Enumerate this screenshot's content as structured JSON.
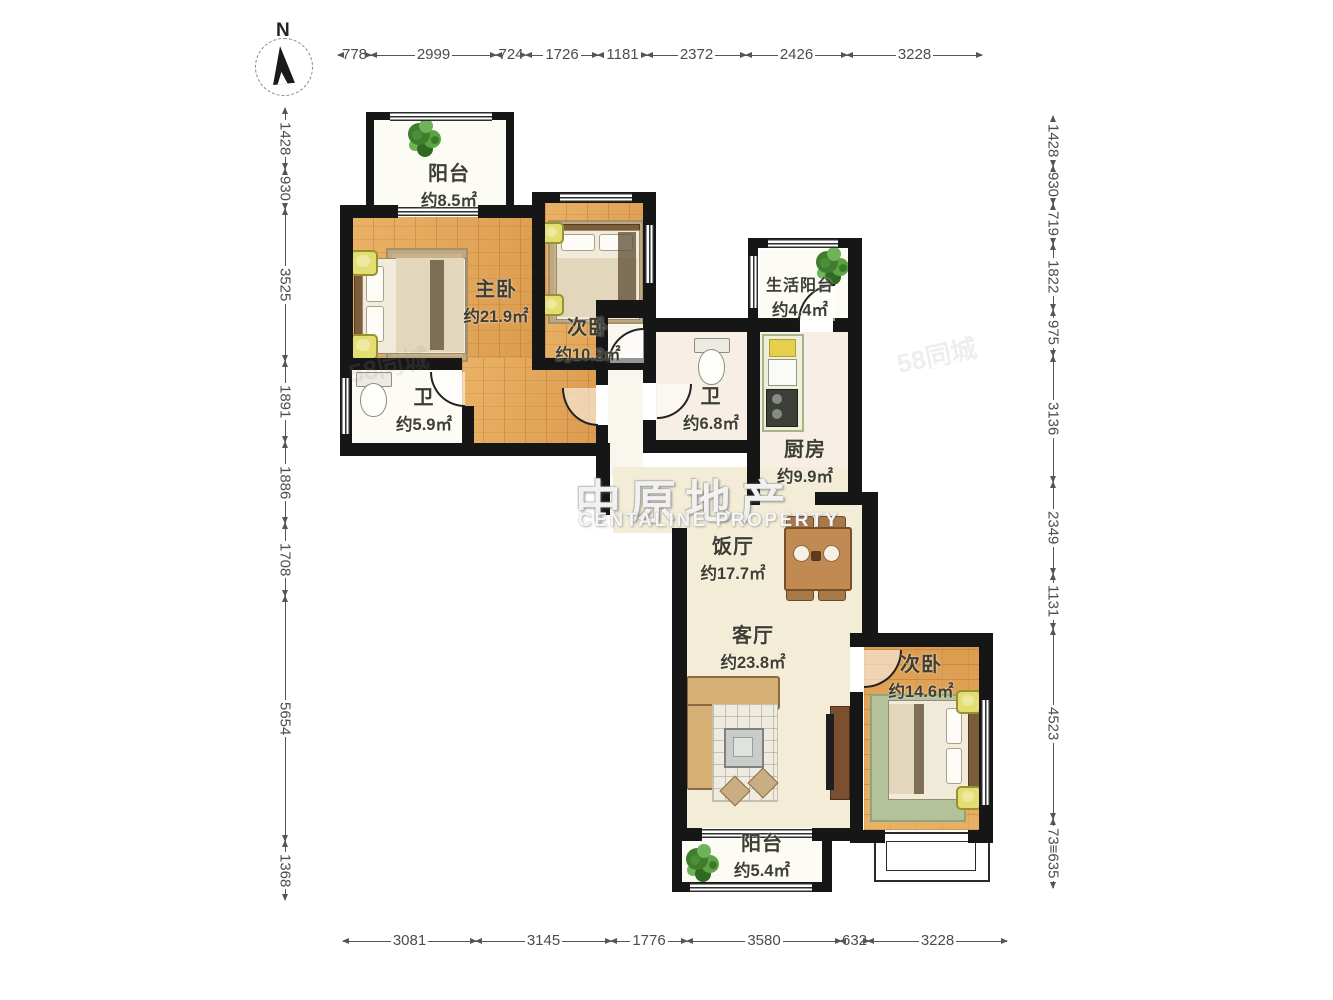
{
  "compass": {
    "label": "N"
  },
  "watermark": {
    "brand": "中原地产",
    "brand_en": "CENTALINE PROPERTY",
    "faint": "58同城"
  },
  "dims": {
    "top": [
      "778",
      "2999",
      "724",
      "1726",
      "1181",
      "2372",
      "2426",
      "3228"
    ],
    "left": [
      "1428",
      "930",
      "3525",
      "1891",
      "1886",
      "1708",
      "5654",
      "1368"
    ],
    "right": [
      "1428",
      "930",
      "719",
      "1822",
      "975",
      "3136",
      "2349",
      "1131",
      "4523",
      "73≡635"
    ],
    "bottom": [
      "3081",
      "3145",
      "1776",
      "3580",
      "632",
      "3228"
    ]
  },
  "rooms": [
    {
      "name": "阳台",
      "area": "约8.5㎡"
    },
    {
      "name": "主卧",
      "area": "约21.9㎡"
    },
    {
      "name": "次卧",
      "area": "约10.2㎡"
    },
    {
      "name": "生活阳台",
      "area": "约4.4㎡"
    },
    {
      "name": "卫",
      "area": "约5.9㎡"
    },
    {
      "name": "卫",
      "area": "约6.8㎡"
    },
    {
      "name": "厨房",
      "area": "约9.9㎡"
    },
    {
      "name": "饭厅",
      "area": "约17.7㎡"
    },
    {
      "name": "客厅",
      "area": "约23.8㎡"
    },
    {
      "name": "次卧",
      "area": "约14.6㎡"
    },
    {
      "name": "阳台",
      "area": "约5.4㎡"
    }
  ],
  "colors": {
    "wall": "#161616",
    "wood_floor": "#e2a45c",
    "living_floor": "#f3edd7",
    "bath_floor": "#f7efe6",
    "accent_yellow": "#e4de72",
    "plant_green": "#3f7c2d"
  }
}
